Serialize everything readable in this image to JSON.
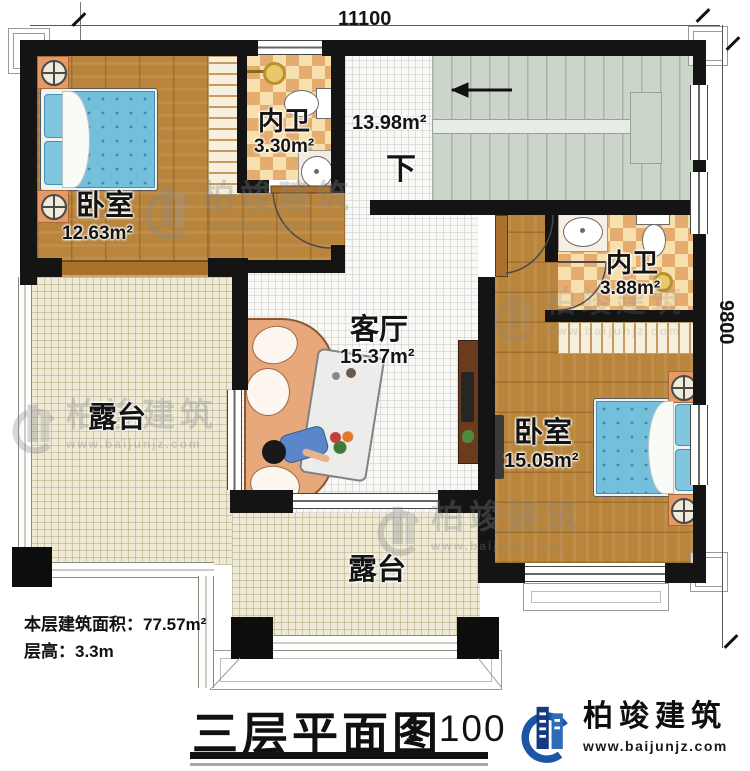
{
  "plan": {
    "title": "三层平面图",
    "scale": "1:100",
    "dim_top": "11100",
    "dim_right": "9800",
    "area_note": "本层建筑面积：77.57m²",
    "height_note": "层高：3.3m",
    "stair_direction": "下",
    "stair_area": "13.98m²"
  },
  "rooms": {
    "bedroom1": {
      "name": "卧室",
      "area": "12.63m²"
    },
    "bath1": {
      "name": "内卫",
      "area": "3.30m²"
    },
    "living": {
      "name": "客厅",
      "area": "15.37m²"
    },
    "bath2": {
      "name": "内卫",
      "area": "3.88m²"
    },
    "bedroom2": {
      "name": "卧室",
      "area": "15.05m²"
    },
    "terrace_left": {
      "name": "露台"
    },
    "terrace_bottom": {
      "name": "露台"
    }
  },
  "brand": {
    "name": "柏竣建筑",
    "url": "www.baijunjz.com"
  },
  "watermark": {
    "name": "柏竣建筑",
    "url": "www.baijunjz.com"
  },
  "colors": {
    "wall": "#141414",
    "wood": "#b9853c",
    "checker_light": "#f7e0ae",
    "checker_dark": "#e4ac6f",
    "stairs": "#ccd5ca",
    "terrace": "#eeead6",
    "tile": "#f8f8f5",
    "bed": "#74c0dc",
    "brand_blue": "#1b55a4"
  }
}
